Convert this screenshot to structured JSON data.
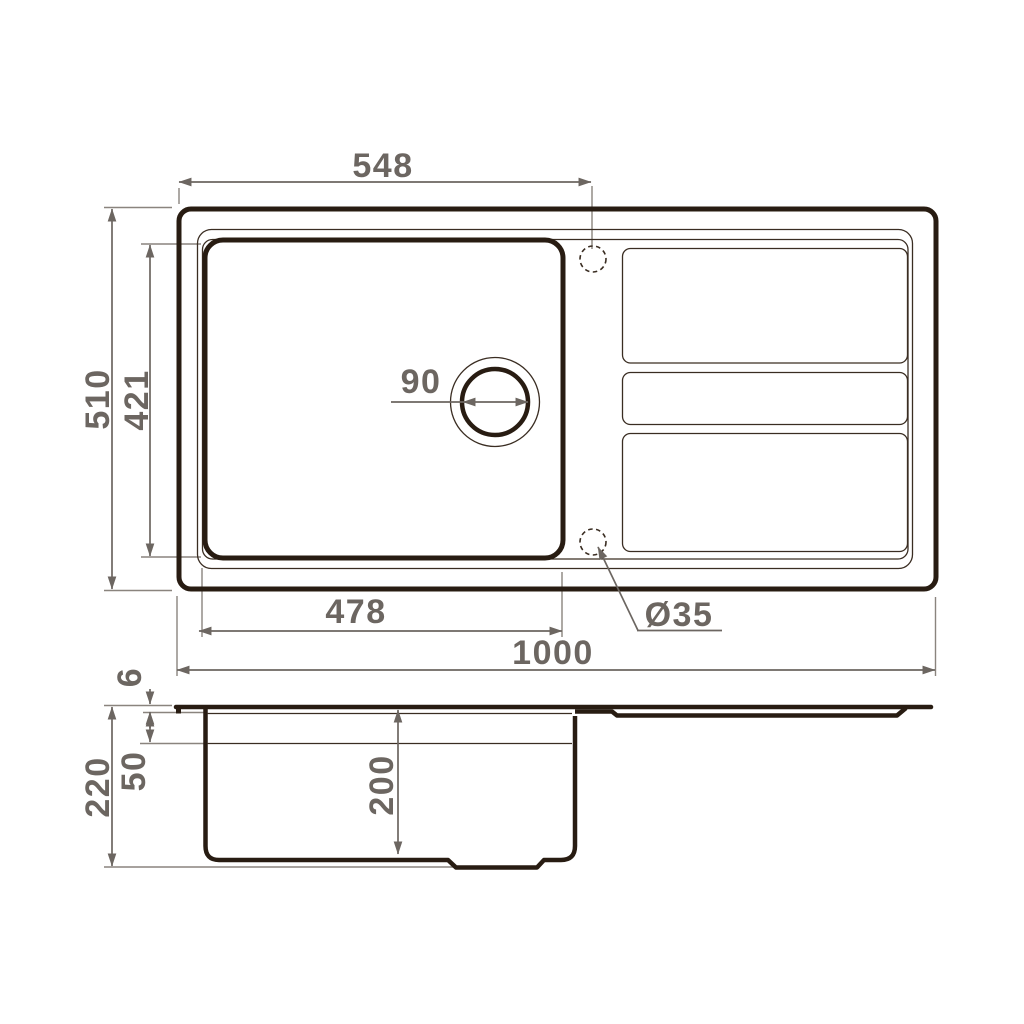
{
  "drawing": {
    "title": "sink-technical-drawing",
    "colors": {
      "outline": "#281c12",
      "dimension": "#6c6661",
      "background": "#ffffff"
    },
    "top_view": {
      "labels": {
        "top_width": "548",
        "overall_depth": "510",
        "bowl_depth": "421",
        "drain_diameter": "90",
        "bowl_width": "478",
        "overall_width": "1000",
        "tap_hole_diameter": "Ø35"
      }
    },
    "side_view": {
      "labels": {
        "rim_thickness": "6",
        "ledge_depth": "50",
        "total_height": "220",
        "bowl_inner_depth": "200"
      }
    }
  }
}
